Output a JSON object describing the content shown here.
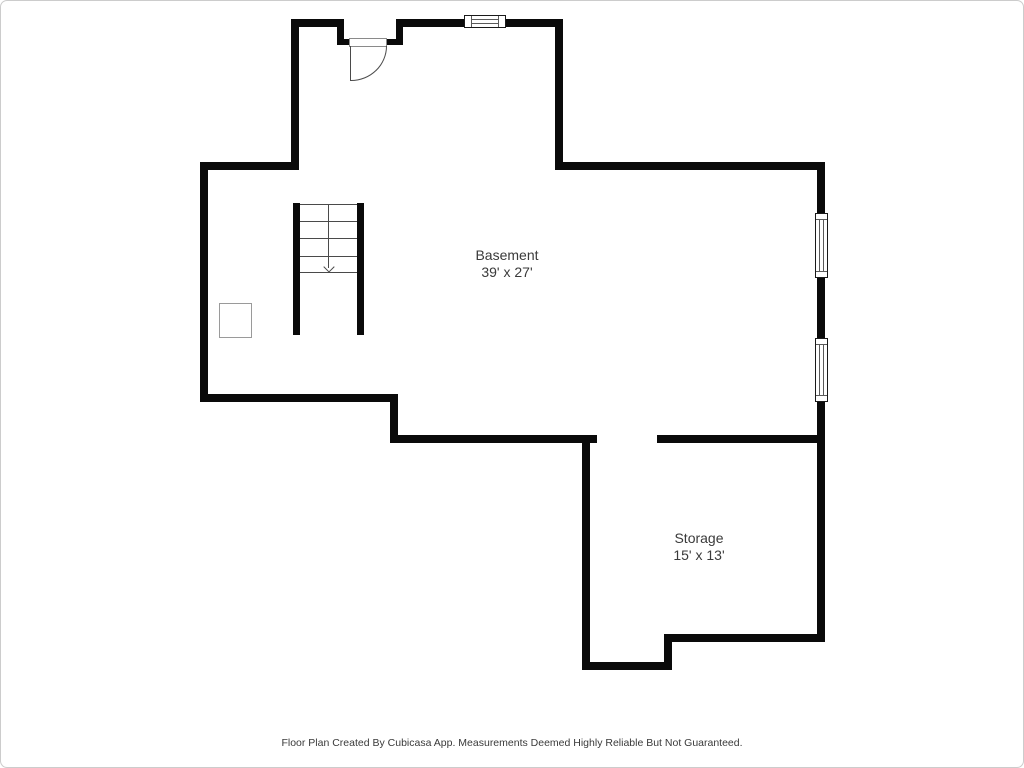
{
  "rooms": [
    {
      "name": "Basement",
      "dimensions": "39' x 27'"
    },
    {
      "name": "Storage",
      "dimensions": "15' x 13'"
    }
  ],
  "footer": {
    "disclaimer": "Floor Plan Created By Cubicasa App. Measurements Deemed Highly Reliable But Not Guaranteed."
  },
  "symbols": {
    "door": "door-swing-symbol",
    "window": "window-symbol",
    "staircase": "staircase-symbol",
    "stair_direction": "down-arrow",
    "post": "support-post-symbol"
  },
  "colors": {
    "wall": "#0a0a0a",
    "room_text": "#3a3a3a",
    "footer_text": "#3a3a3a",
    "frame_border": "#cccccc",
    "background": "#ffffff"
  }
}
